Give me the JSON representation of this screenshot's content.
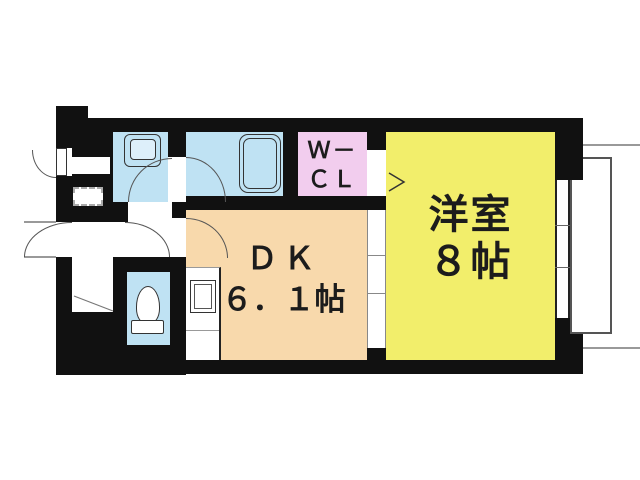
{
  "floorplan": {
    "rooms": {
      "western": {
        "name": "洋室",
        "size": "８帖",
        "color": "#F2EE6B"
      },
      "dk": {
        "name": "ＤＫ",
        "size": "６．１帖",
        "color": "#F8D9AC"
      },
      "wcl": {
        "line1": "Ｗ－",
        "line2": "ＣＬ",
        "color": "#F2CDEE"
      },
      "bathroom": {
        "color": "#BFE2F3"
      },
      "washroom": {
        "color": "#BFE2F3"
      },
      "toilet": {
        "color": "#BFE2F3"
      }
    },
    "wall_color": "#111111",
    "fixtures": [
      "bathtub-icon",
      "washbasin-icon",
      "toilet-icon",
      "kitchen-sink-icon",
      "washing-machine-pan-icon"
    ]
  }
}
